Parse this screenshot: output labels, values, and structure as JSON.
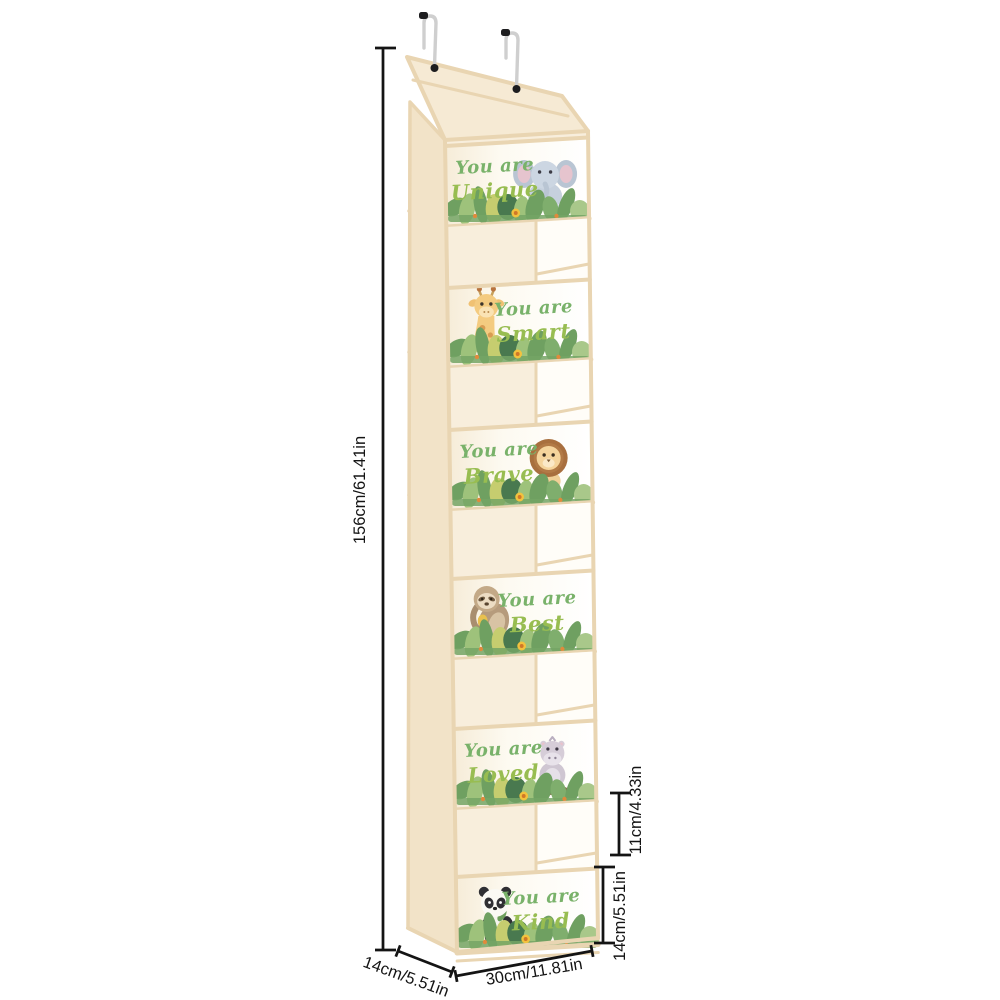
{
  "product": {
    "pockets": [
      {
        "line1": "You are",
        "line2": "Unique",
        "animal": "elephant",
        "animal_side": "right"
      },
      {
        "line1": "You are",
        "line2": "Smart",
        "animal": "giraffe",
        "animal_side": "left"
      },
      {
        "line1": "You are",
        "line2": "Brave",
        "animal": "lion",
        "animal_side": "right"
      },
      {
        "line1": "You are",
        "line2": "Best",
        "animal": "sloth",
        "animal_side": "left"
      },
      {
        "line1": "You are",
        "line2": "Loved",
        "animal": "hippo",
        "animal_side": "right"
      },
      {
        "line1": "You are",
        "line2": "Kind",
        "animal": "panda",
        "animal_side": "left"
      }
    ]
  },
  "dimensions": {
    "height": "156cm/61.41in",
    "width": "30cm/11.81in",
    "depth": "14cm/5.51in",
    "pocket_gap": "11cm/4.33in",
    "pocket_height": "14cm/5.51in"
  },
  "colors": {
    "fabric_light": "#f8eedc",
    "fabric_side": "#f2e3c8",
    "fabric_flap": "#f6ead4",
    "frame": "#e9d5b2",
    "pocket_white": "#fffdf8",
    "script_green_1": "#79b26a",
    "script_green_2": "#98bd51",
    "dimension_color": "#141414",
    "hook_metal": "#cfcfcf",
    "hook_tip": "#1d1d1f",
    "leaf_dark": "#49794f",
    "leaf_mid": "#6fa061",
    "leaf_light": "#9ec27b",
    "leaf_yellow": "#c6cd6f",
    "flower_yellow": "#f2c23e"
  }
}
